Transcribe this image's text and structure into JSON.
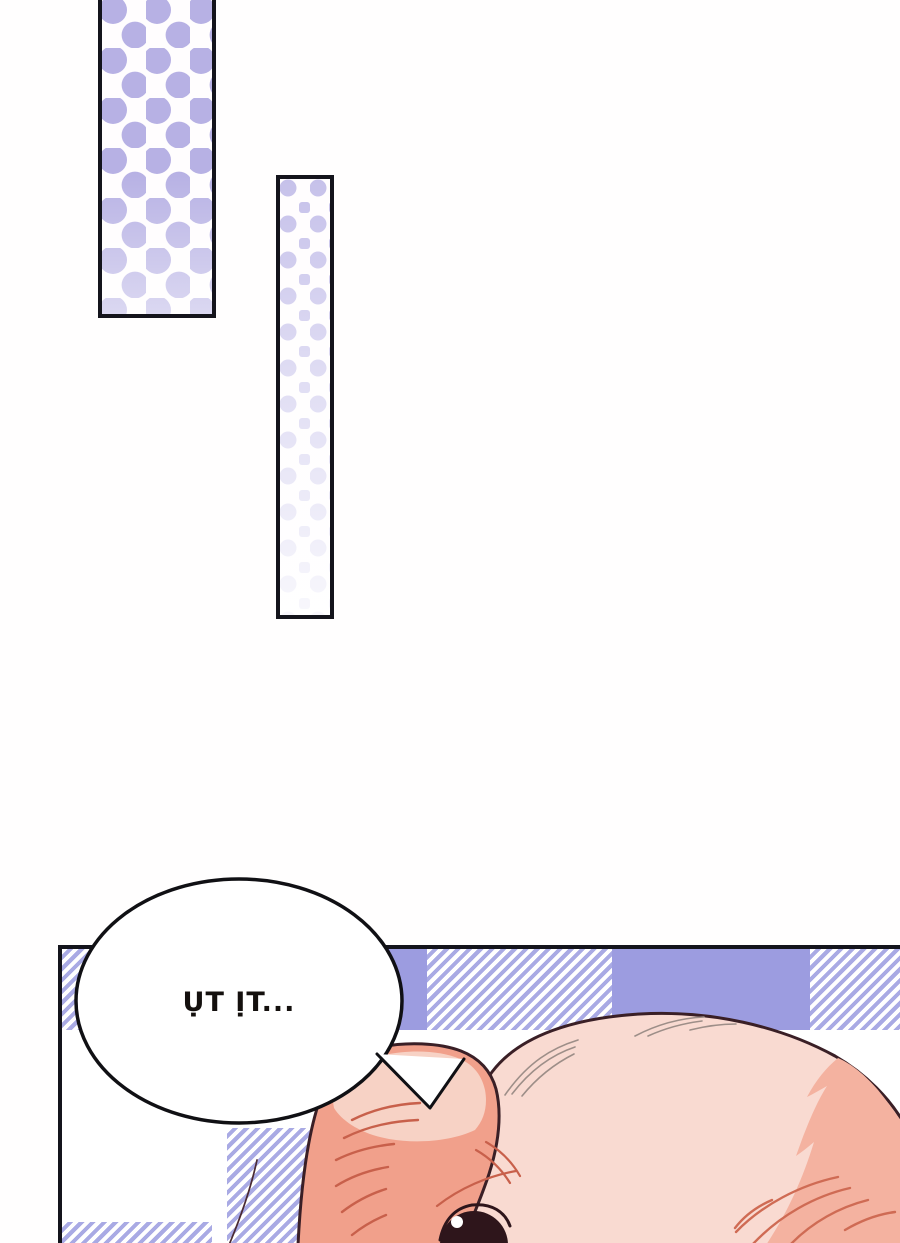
{
  "page": {
    "kind": "comic-page",
    "background_color": "#fffefe",
    "panel_border_color": "#14141c"
  },
  "speech_bubble": {
    "text": "ỤT ỊT...",
    "fill_color": "#ffffff",
    "border_color": "#101014",
    "text_color": "#14100e"
  },
  "panels": {
    "top_left_panel": {
      "pattern": "polka-dots",
      "dot_color": "#b7b1e4",
      "background": "#fffdfe"
    },
    "middle_panel": {
      "pattern": "polka-dots-fading",
      "dot_color": "#c6c1ea",
      "background": "#fffdfe"
    },
    "bottom_panel": {
      "pattern": "gingham-plaid",
      "plaid_solid_color": "#9c9ce0",
      "plaid_stripe_color": "#a9aae4",
      "character": "pig-head",
      "head_color": "#f9dad1",
      "head_shading_color": "#f4b2a0",
      "ear_color": "#f1a08b",
      "ear_highlight_color": "#f7d2c5",
      "wrinkle_color": "#c8604b",
      "eye_color": "#2e151b",
      "outline_color": "#3a1f26"
    }
  }
}
